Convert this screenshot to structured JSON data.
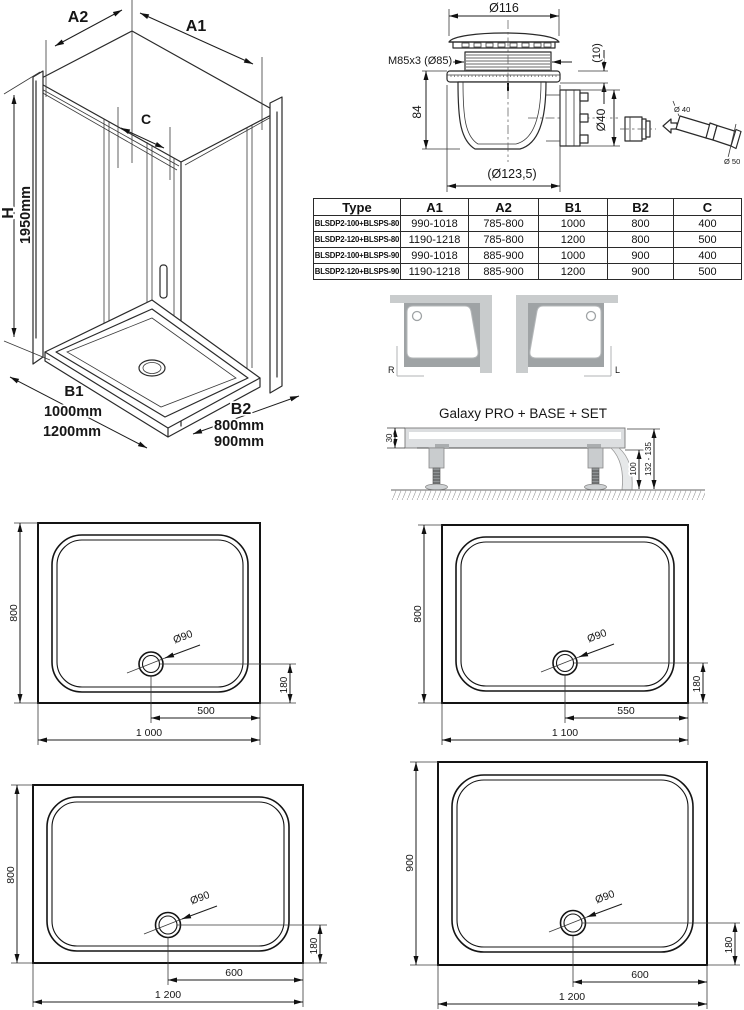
{
  "enclosure": {
    "width_back_label": "A2",
    "width_front_label": "A1",
    "door_label": "C",
    "height_label": "H",
    "height_value": "1950mm",
    "depth_label": "B1",
    "depth_values": [
      "1000mm",
      "1200mm"
    ],
    "side_label": "B2",
    "side_values": [
      "800mm",
      "900mm"
    ]
  },
  "drain": {
    "cap_diameter": "Ø116",
    "thread": "M85x3 (Ø85)",
    "collar_height": "(10)",
    "body_height": "84",
    "outlet_diameter": "Ø40",
    "flange_diameter": "(Ø123,5)",
    "pipe_inlet_diameter": "Ø 40",
    "pipe_outlet_diameter": "Ø 50"
  },
  "table": {
    "headers": [
      "Type",
      "A1",
      "A2",
      "B1",
      "B2",
      "C"
    ],
    "rows": [
      [
        "BLSDP2-100+BLSPS-80",
        "990-1018",
        "785-800",
        "1000",
        "800",
        "400"
      ],
      [
        "BLSDP2-120+BLSPS-80",
        "1190-1218",
        "785-800",
        "1200",
        "800",
        "500"
      ],
      [
        "BLSDP2-100+BLSPS-90",
        "990-1018",
        "885-900",
        "1000",
        "900",
        "400"
      ],
      [
        "BLSDP2-120+BLSPS-90",
        "1190-1218",
        "885-900",
        "1200",
        "900",
        "500"
      ]
    ]
  },
  "orientation": {
    "right": "R",
    "left": "L"
  },
  "base": {
    "title": "Galaxy PRO + BASE + SET",
    "rim_height": "30",
    "leg_height": "100",
    "total_height": "132 - 135"
  },
  "trays": [
    {
      "depth": "800",
      "drain_diameter": "Ø90",
      "drain_offset": "180",
      "drain_from_edge": "500",
      "width": "1 000"
    },
    {
      "depth": "800",
      "drain_diameter": "Ø90",
      "drain_offset": "180",
      "drain_from_edge": "550",
      "width": "1 100"
    },
    {
      "depth": "800",
      "drain_diameter": "Ø90",
      "drain_offset": "180",
      "drain_from_edge": "600",
      "width": "1 200"
    },
    {
      "depth": "900",
      "drain_diameter": "Ø90",
      "drain_offset": "180",
      "drain_from_edge": "600",
      "width": "1 200"
    }
  ]
}
